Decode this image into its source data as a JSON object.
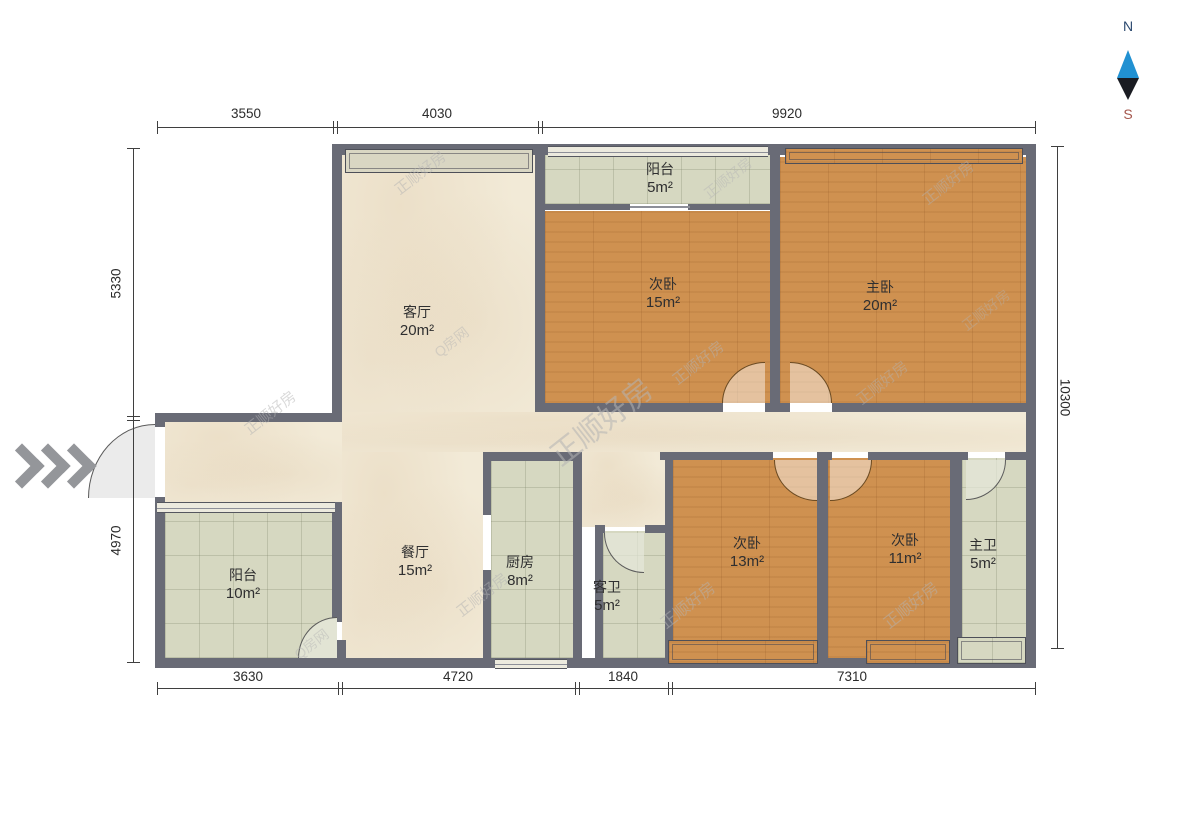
{
  "title": "apartment-floor-plan",
  "compass": {
    "north": "N",
    "south": "S"
  },
  "dimensions": {
    "top": [
      {
        "label": "3550"
      },
      {
        "label": "4030"
      },
      {
        "label": "9920"
      }
    ],
    "bottom": [
      {
        "label": "3630"
      },
      {
        "label": "4720"
      },
      {
        "label": "1840"
      },
      {
        "label": "7310"
      }
    ],
    "left": [
      {
        "label": "5330"
      },
      {
        "label": "4970"
      }
    ],
    "right": [
      {
        "label": "10300"
      }
    ]
  },
  "rooms": [
    {
      "name": "阳台",
      "area": "5m²"
    },
    {
      "name": "次卧",
      "area": "15m²"
    },
    {
      "name": "主卧",
      "area": "20m²"
    },
    {
      "name": "客厅",
      "area": "20m²"
    },
    {
      "name": "餐厅",
      "area": "15m²"
    },
    {
      "name": "厨房",
      "area": "8m²"
    },
    {
      "name": "客卫",
      "area": "5m²"
    },
    {
      "name": "次卧",
      "area": "13m²"
    },
    {
      "name": "次卧",
      "area": "11m²"
    },
    {
      "name": "主卫",
      "area": "5m²"
    },
    {
      "name": "阳台",
      "area": "10m²"
    }
  ],
  "watermark": {
    "text": "正顺好房",
    "alt": "Q房网"
  },
  "colors": {
    "wall": "#696b76",
    "wood_floor": "#cf9150",
    "tile_floor": "#d6d8c1",
    "marble_floor": "#f2ead7",
    "compass_north_text": "#2c4a70",
    "compass_south_text": "#a5574d",
    "compass_needle_up": "#2191d2",
    "compass_needle_down": "#1a1c22"
  }
}
